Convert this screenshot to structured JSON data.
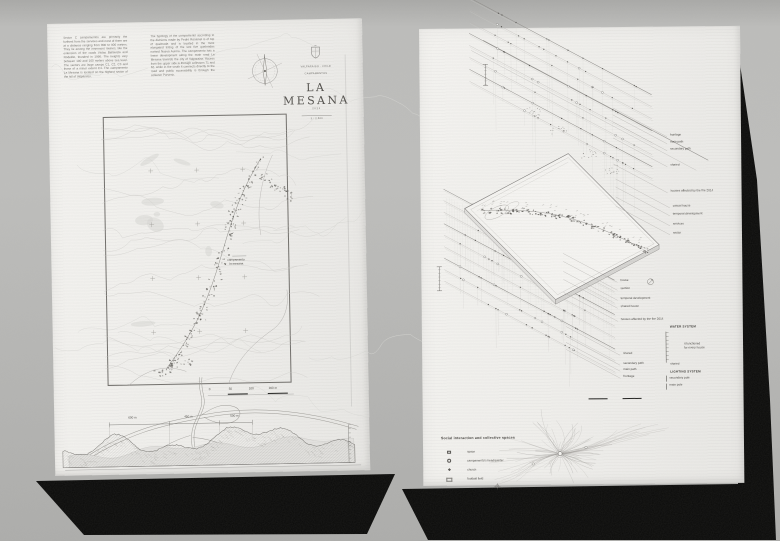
{
  "wall_color": "#b7b7b5",
  "icons": [
    "compass-rose-icon",
    "crest-icon",
    "north-arrow-icon"
  ],
  "left_poster": {
    "intro_col1": "Sector C campamentos are primarily the furthest from the services and most of them are at a distance ranging from 800 to 900 meters. They lie among the innermost ravines, like the extension of the roads Vistas Bellavista and Rodelillo, founded in 1990. The heights vary between 100 and 160 meters above sea level. The sectors are large camps C1, C2, C3 and those of a minor extent C4. The campamento La Mesana is located on the highest sector of the hill of Valparaiso.",
    "intro_col2": "The typology of the campamento according to the divisions made by Pedro Rosamel is of top of quebrada and is located in the most elongated listing of the last five quebradas named Nueva Aurora. The campamento has a linear development along the main road La Mesana towards the city of Valparaiso. Access from the upper side is through collectors 71 and 62, while in the south it connects directly to the road and public accessibility is through the collector Porvenir.",
    "title_block": {
      "eyebrow_1": "VALPARAISO · CHILE",
      "eyebrow_2": "CAMPAMENTOS",
      "title": "LA MESANA",
      "year": "2021",
      "scale_note": "1 : 2.500"
    },
    "map_label_1": "campamento",
    "map_label_2": "la mesana",
    "scalebar_ticks": [
      "0",
      "50",
      "100",
      "200 m"
    ],
    "section_dims": [
      "600 m",
      "450 m",
      "500 m"
    ]
  },
  "right_poster": {
    "layer_labels_top": [
      "frontage",
      "main path",
      "secondary path",
      "shared",
      "houses affected by the fire 2014"
    ],
    "layer_labels_mid": [
      "casual house",
      "temporal development",
      "services",
      "sector"
    ],
    "layer_labels_bottom": [
      "house",
      "section",
      "temporal development",
      "shared house",
      "houses affected by the fire 2014",
      "shared",
      "secondary path",
      "main path",
      "frontage"
    ],
    "water_legend": {
      "title": "WATER SYSTEM",
      "item": "shared",
      "note_1": "it functioned",
      "note_2": "for every house"
    },
    "lighting_legend": {
      "title": "LIGHTING SYSTEM",
      "items": [
        "secondary pole",
        "main pole"
      ]
    },
    "social_legend": {
      "title": "Social interaction and collective spaces",
      "items": [
        "space",
        "campamento's headquarter",
        "church",
        "football field"
      ]
    }
  }
}
